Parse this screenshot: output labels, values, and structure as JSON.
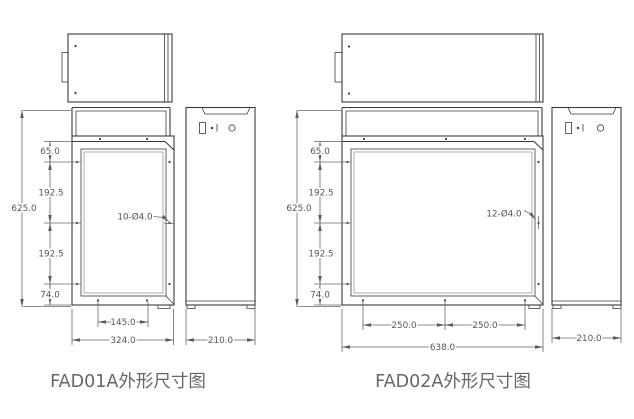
{
  "page": {
    "background_color": "#ffffff",
    "line_color": "#3b3b3b",
    "dimension_color": "#666666",
    "text_color": "#555555"
  },
  "drawings": [
    {
      "name": "FAD01A",
      "title": "FAD01A外形尺寸图",
      "hole_callout": "10-Ø4.0",
      "dims": {
        "total_height": "625.0",
        "top_to_first_hole": "65.0",
        "upper_hole_pitch": "192.5",
        "lower_hole_pitch": "192.5",
        "last_hole_to_bottom": "74.0",
        "bottom_hole_span": "145.0",
        "overall_width": "324.0",
        "depth": "210.0"
      }
    },
    {
      "name": "FAD02A",
      "title": "FAD02A外形尺寸图",
      "hole_callout": "12-Ø4.0",
      "dims": {
        "total_height": "625.0",
        "top_to_first_hole": "65.0",
        "upper_hole_pitch": "192.5",
        "lower_hole_pitch": "192.5",
        "last_hole_to_bottom": "74.0",
        "bottom_hole_span_left": "250.0",
        "bottom_hole_span_right": "250.0",
        "overall_width": "638.0",
        "depth": "210.0"
      }
    }
  ]
}
